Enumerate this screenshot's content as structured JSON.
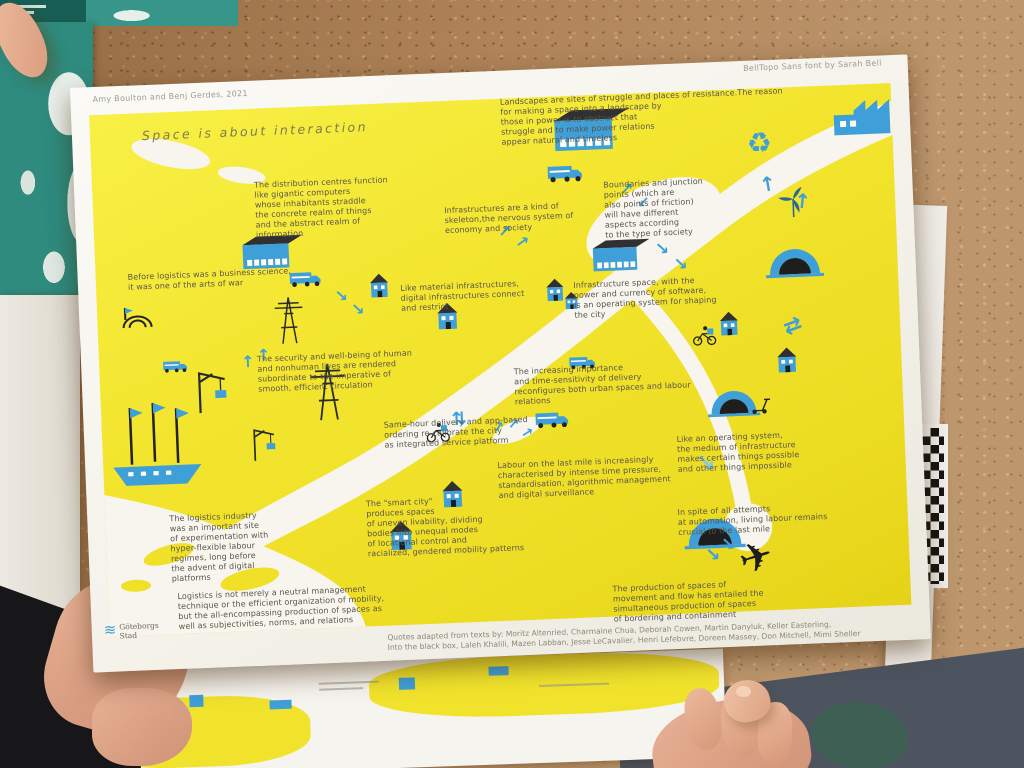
{
  "poster": {
    "authors": "Amy Boulton and Benj Gerdes, 2021",
    "font_credit": "BellTopo Sans font by Sarah Bell",
    "title": "Space is about interaction",
    "quotes": [
      {
        "text": "Landscapes are sites of struggle and places of resistance.The reason\nfor making a space into a landscape by\nthose in power is to obstruct that\nstruggle and to make power relations\nappear natural and timeless"
      },
      {
        "text": "The distribution centres function\nlike gigantic computers\nwhose inhabitants straddle\nthe concrete realm of things\nand the abstract realm of\ninformation"
      },
      {
        "text": "Infrastructures are a kind of\nskeleton,the nervous system of\neconomy and society"
      },
      {
        "text": "Boundaries and junction\npoints (which are\nalso points of friction)\nwill have different\naspects according\nto the type of society"
      },
      {
        "text": "Before logistics was a business science,\nit was one of the arts of war"
      },
      {
        "text": "Like material infrastructures,\ndigital infrastructures connect\nand restrict"
      },
      {
        "text": "Infrastructure space, with the\npower and currency of software,\nis an operating system for shaping\nthe city"
      },
      {
        "text": "The security and well-being of human\nand nonhuman lives are rendered\nsubordinate to the imperative of\nsmooth, efficient circulation"
      },
      {
        "text": "The increasing importance\nand time-sensitivity of delivery\nreconfigures both urban spaces and labour\nrelations"
      },
      {
        "text": "Same-hour delivery and app-based\nordering re-calibrate the city\nas integrated service platform"
      },
      {
        "text": "Labour on the last mile is increasingly\ncharacterised by intense time pressure,\nstandardisation, algorithmic management\nand digital surveillance"
      },
      {
        "text": "Like an operating system,\nthe medium of infrastructure\nmakes certain things possible\nand other things impossible"
      },
      {
        "text": "The \"smart city\"\nproduces spaces\nof uneven livability, dividing\nbodies into unequal modes\nof locational control and\nracialized, gendered mobility patterns"
      },
      {
        "text": "In spite of all attempts\nat automation, living labour remains\ncrucial to the last mile"
      },
      {
        "text": "The logistics industry\nwas an important site\nof experimentation with\nhyper-flexible labour\nregimes, long before\nthe advent of digital\nplatforms"
      },
      {
        "text": "Logistics is not merely a neutral management\ntechnique or the efficient organization of mobility,\nbut the all-encompassing production of spaces as\nwell as subjectivities, norms, and relations"
      },
      {
        "text": "The production of spaces of\nmovement and flow has entailed the\nsimultaneous production of spaces\nof bordering and containment"
      }
    ],
    "credits_line": "Quotes adapted from texts by: Moritz Altenried, Charmaine Chua, Deborah Cowen, Martin Danyluk, Keller Easterling,\nInto the black box, Laleh Khalili, Mazen Labban, Jesse LeCavalier, Henri Lefebvre, Doreen Massey, Don Mitchell, Mimi Sheller",
    "logo_text": "Göteborgs\nStad"
  },
  "icons": {
    "recycle": "♻",
    "plane": "✈",
    "arrow_up": "↑",
    "arrow_ne": "↗",
    "arrow_se": "↘",
    "arrow_sw": "↙",
    "arrow_swap": "⇄",
    "waves": "≋"
  },
  "illustrations": [
    "warehouse",
    "factory",
    "recycling",
    "delivery-truck",
    "house",
    "power-pylon",
    "harbour-crane",
    "sailing-ship",
    "road-tunnel",
    "cargo-bike-courier",
    "kick-scooter",
    "wind-turbine",
    "airplane",
    "flow-arrow",
    "river-map"
  ],
  "colors": {
    "poster_yellow": "#f2e52c",
    "print_blue": "#3f9fd8",
    "ink": "#59554b",
    "cork": "#b0845a",
    "teal_poster": "#2e8b7e"
  }
}
